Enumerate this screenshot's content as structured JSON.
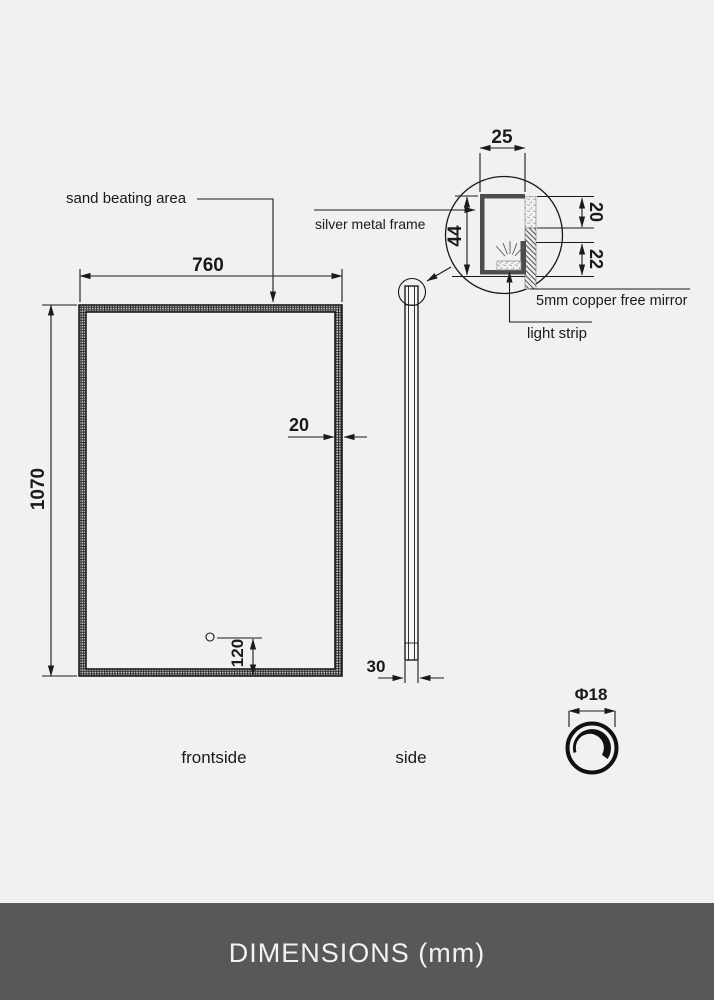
{
  "views": {
    "front": {
      "label": "frontside",
      "width_dim": "760",
      "height_dim": "1070",
      "frame_width_dim": "20",
      "sensor_offset_dim": "120",
      "sand_area_label": "sand beating area"
    },
    "side": {
      "label": "side",
      "thickness_dim": "30"
    },
    "detail": {
      "frame_label": "silver metal frame",
      "mirror_label": "5mm copper free mirror",
      "light_strip_label": "light strip",
      "depth_dim": "25",
      "height_dim": "44",
      "sand_return_dim": "20",
      "lower_return_dim": "22"
    },
    "knob": {
      "diameter_dim": "Φ18"
    }
  },
  "footer": {
    "title": "DIMENSIONS (mm)"
  },
  "colors": {
    "background": "#f1f1f1",
    "line": "#1a1a1a",
    "frame_profile": "#4d4d4d",
    "footer_bg": "#58585a",
    "footer_text": "#f2f2f2"
  }
}
